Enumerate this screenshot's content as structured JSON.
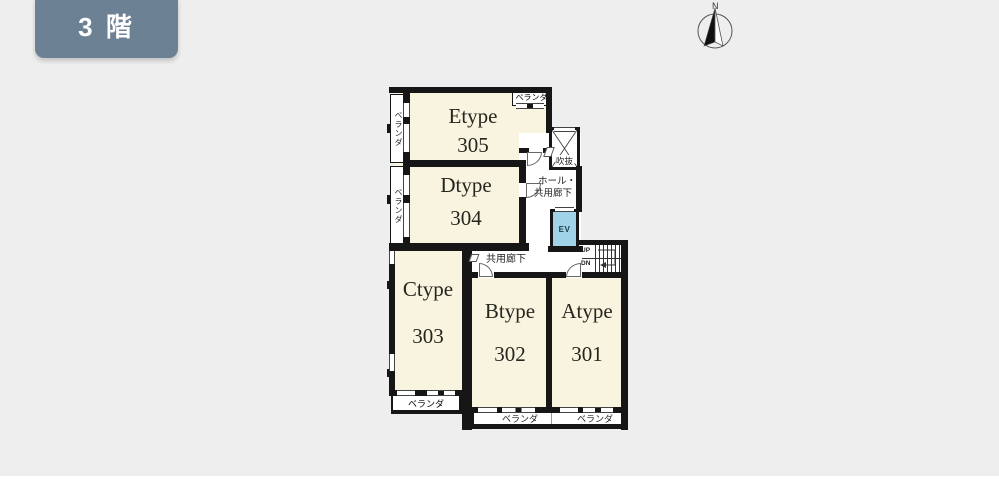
{
  "page": {
    "background_color": "#eeeeef"
  },
  "floor_badge": {
    "label": "3 階",
    "background_color": "#6d8194",
    "text_color": "#ffffff"
  },
  "compass": {
    "north_label": "N"
  },
  "colors": {
    "wall": "#161616",
    "room_fill": "#f8f4e0",
    "common_area_fill": "#ffffff",
    "elevator_fill": "#a0d3e8"
  },
  "rooms": [
    {
      "type": "Etype",
      "number": "305"
    },
    {
      "type": "Dtype",
      "number": "304"
    },
    {
      "type": "Ctype",
      "number": "303"
    },
    {
      "type": "Btype",
      "number": "302"
    },
    {
      "type": "Atype",
      "number": "301"
    }
  ],
  "labels": {
    "balcony": "ベランダ",
    "void": "吹抜",
    "hall_line1": "ホール・",
    "hall_line2": "共用廊下",
    "corridor": "共用廊下",
    "elevator": "EV",
    "up": "UP",
    "down": "DN"
  }
}
